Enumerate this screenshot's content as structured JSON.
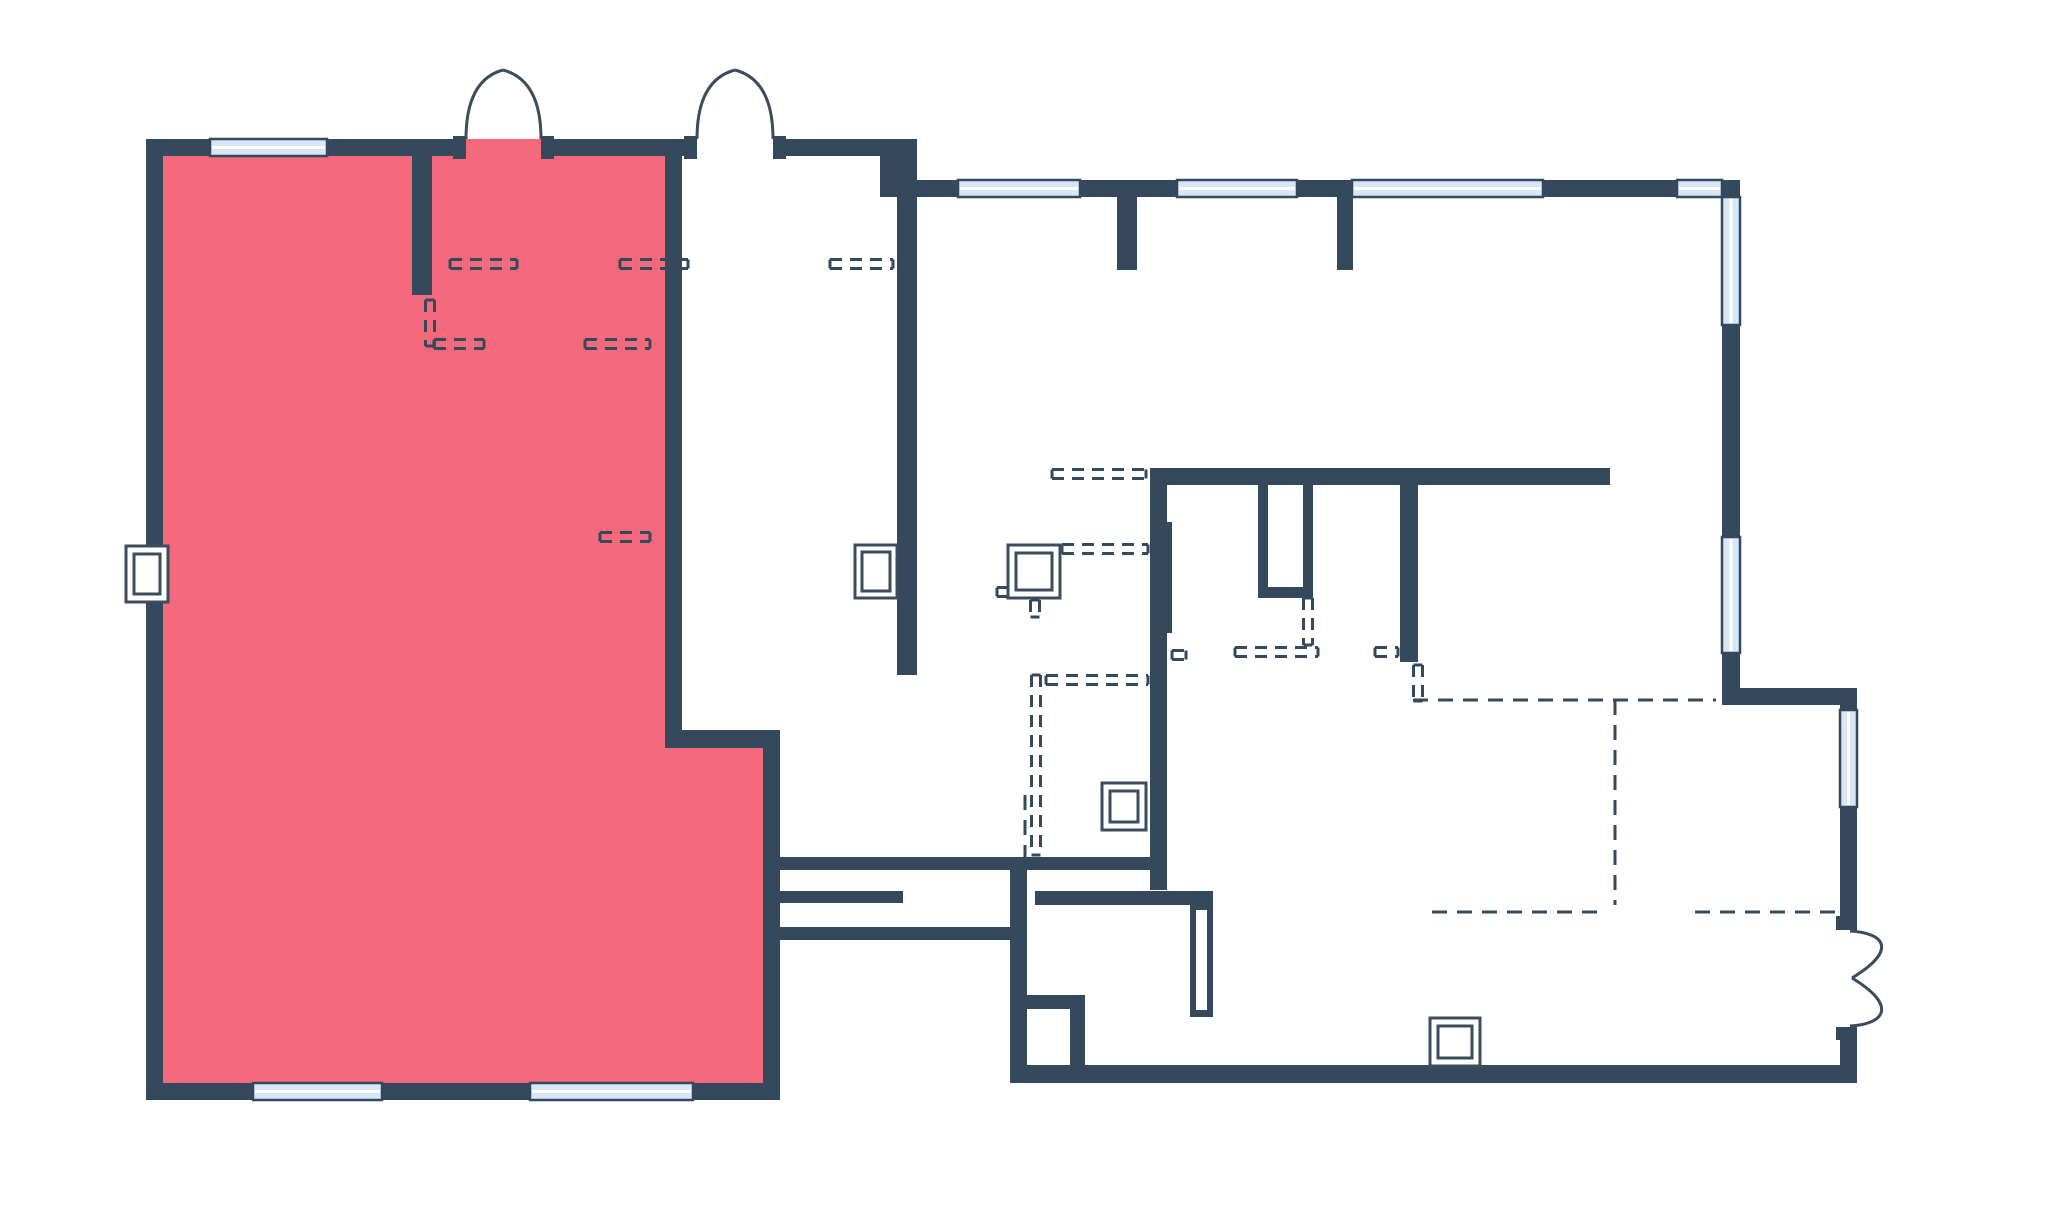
{
  "canvas": {
    "width": 2048,
    "height": 1205,
    "background": "#ffffff"
  },
  "colors": {
    "wall": "#35495c",
    "highlight_fill": "#f4697b",
    "window_fill": "#d8e7f6",
    "window_center_line": "#ffffff",
    "door_stroke": "#3b4c5c",
    "dash_stroke": "#35495c",
    "fixture_stroke": "#3b4c5c",
    "fixture_fill": "#ffffff"
  },
  "highlight_room": {
    "polygon": [
      [
        163,
        156
      ],
      [
        665,
        156
      ],
      [
        665,
        748
      ],
      [
        763,
        748
      ],
      [
        763,
        1083
      ],
      [
        163,
        1083
      ]
    ],
    "extra_rects": [
      [
        466,
        139,
        75,
        18
      ]
    ]
  },
  "walls": [
    [
      146,
      139,
      17,
      961
    ],
    [
      146,
      139,
      64,
      17
    ],
    [
      327,
      139,
      139,
      17
    ],
    [
      541,
      139,
      156,
      17
    ],
    [
      773,
      139,
      127,
      17
    ],
    [
      880,
      139,
      37,
      58
    ],
    [
      917,
      180,
      41,
      17
    ],
    [
      1080,
      180,
      97,
      17
    ],
    [
      1297,
      180,
      55,
      17
    ],
    [
      1543,
      180,
      134,
      17
    ],
    [
      1722,
      180,
      18,
      17
    ],
    [
      1722,
      325,
      18,
      212
    ],
    [
      1722,
      653,
      18,
      47
    ],
    [
      1722,
      688,
      135,
      17
    ],
    [
      1840,
      688,
      17,
      22
    ],
    [
      1840,
      807,
      17,
      111
    ],
    [
      1840,
      1027,
      17,
      56
    ],
    [
      1010,
      1065,
      847,
      18
    ],
    [
      146,
      1083,
      107,
      17
    ],
    [
      382,
      1083,
      148,
      17
    ],
    [
      693,
      1083,
      87,
      17
    ],
    [
      665,
      156,
      17,
      574
    ],
    [
      665,
      730,
      115,
      18
    ],
    [
      763,
      748,
      17,
      352
    ],
    [
      412,
      156,
      20,
      139
    ],
    [
      897,
      197,
      20,
      478
    ],
    [
      1117,
      197,
      20,
      73
    ],
    [
      1337,
      197,
      16,
      73
    ],
    [
      1150,
      468,
      460,
      17
    ],
    [
      1150,
      485,
      17,
      405
    ],
    [
      1167,
      522,
      5,
      111
    ],
    [
      1258,
      485,
      10,
      113
    ],
    [
      1303,
      485,
      10,
      113
    ],
    [
      1258,
      587,
      55,
      11
    ],
    [
      1400,
      485,
      18,
      177
    ],
    [
      780,
      857,
      370,
      13
    ],
    [
      775,
      891,
      128,
      12
    ],
    [
      1035,
      891,
      178,
      14
    ],
    [
      775,
      927,
      235,
      13
    ],
    [
      1010,
      870,
      17,
      213
    ],
    [
      1010,
      995,
      75,
      14
    ],
    [
      1070,
      1009,
      15,
      74
    ],
    [
      1190,
      905,
      23,
      112
    ],
    [
      453,
      136,
      13,
      23
    ],
    [
      541,
      136,
      13,
      23
    ],
    [
      684,
      136,
      13,
      23
    ],
    [
      773,
      136,
      13,
      23
    ],
    [
      1836,
      916,
      21,
      14
    ],
    [
      1836,
      1027,
      21,
      13
    ]
  ],
  "white_slots": [
    [
      1196,
      910,
      11,
      100
    ]
  ],
  "windows": [
    {
      "rect": [
        210,
        139,
        117,
        17
      ],
      "orient": "h"
    },
    {
      "rect": [
        958,
        180,
        122,
        17
      ],
      "orient": "h"
    },
    {
      "rect": [
        1177,
        180,
        120,
        17
      ],
      "orient": "h"
    },
    {
      "rect": [
        1352,
        180,
        191,
        17
      ],
      "orient": "h"
    },
    {
      "rect": [
        1677,
        180,
        45,
        17
      ],
      "orient": "h"
    },
    {
      "rect": [
        1722,
        197,
        18,
        128
      ],
      "orient": "v"
    },
    {
      "rect": [
        1722,
        537,
        18,
        116
      ],
      "orient": "v"
    },
    {
      "rect": [
        1840,
        710,
        17,
        97
      ],
      "orient": "v"
    },
    {
      "rect": [
        253,
        1083,
        129,
        17
      ],
      "orient": "h"
    },
    {
      "rect": [
        530,
        1083,
        163,
        17
      ],
      "orient": "h"
    }
  ],
  "doors": [
    {
      "name": "double-door-top-left",
      "path": "M466,139 Q466,80 503,70 M541,139 Q541,80 503,70"
    },
    {
      "name": "double-door-top-center",
      "path": "M697,139 Q697,80 735,70 M773,139 Q773,80 735,70"
    },
    {
      "name": "french-door-right",
      "path": "M1850,931 C1885,933 1898,950 1852,978 M1850,1026 C1885,1024 1898,1006 1852,978"
    }
  ],
  "dashed_double": [
    {
      "p": [
        430,
        300,
        430,
        346
      ]
    },
    {
      "p": [
        434,
        344,
        484,
        344
      ]
    },
    {
      "p": [
        585,
        344,
        650,
        344
      ]
    },
    {
      "p": [
        450,
        264,
        517,
        264
      ]
    },
    {
      "p": [
        620,
        264,
        688,
        264
      ]
    },
    {
      "p": [
        830,
        264,
        893,
        264
      ]
    },
    {
      "p": [
        600,
        537,
        650,
        537
      ]
    },
    {
      "p": [
        1036,
        675,
        1036,
        855
      ]
    },
    {
      "p": [
        1046,
        680,
        1148,
        680
      ]
    },
    {
      "p": [
        1062,
        549,
        1148,
        549
      ]
    },
    {
      "p": [
        1035,
        600,
        1035,
        617
      ]
    },
    {
      "p": [
        1308,
        598,
        1308,
        645
      ]
    },
    {
      "p": [
        1235,
        652,
        1318,
        652
      ]
    },
    {
      "p": [
        1172,
        655,
        1186,
        655
      ]
    },
    {
      "p": [
        1375,
        652,
        1398,
        652
      ]
    },
    {
      "p": [
        1418,
        665,
        1418,
        701
      ]
    },
    {
      "p": [
        1052,
        474,
        1146,
        474
      ]
    },
    {
      "p": [
        997,
        592,
        1010,
        592
      ]
    }
  ],
  "dashed_single": [
    {
      "p": [
        1413,
        700,
        1716,
        700
      ]
    },
    {
      "p": [
        1615,
        700,
        1615,
        905
      ]
    },
    {
      "p": [
        1432,
        912,
        1607,
        912
      ]
    },
    {
      "p": [
        1695,
        912,
        1836,
        912
      ]
    },
    {
      "p": [
        1025,
        795,
        1025,
        857
      ]
    }
  ],
  "fixtures": [
    {
      "name": "sink-fixture",
      "outer": [
        855,
        545,
        42,
        53
      ],
      "inner": [
        862,
        552,
        28,
        39
      ]
    },
    {
      "name": "toilet-fixture",
      "outer": [
        1008,
        545,
        52,
        53
      ],
      "inner": [
        1016,
        553,
        36,
        37
      ]
    },
    {
      "name": "wall-box-fixture",
      "outer": [
        126,
        546,
        42,
        56
      ],
      "inner": [
        134,
        554,
        26,
        40
      ]
    },
    {
      "name": "drain-fixture",
      "outer": [
        1102,
        783,
        44,
        47
      ],
      "inner": [
        1110,
        791,
        28,
        31
      ]
    },
    {
      "name": "floor-fixture",
      "outer": [
        1430,
        1018,
        50,
        48
      ],
      "inner": [
        1438,
        1026,
        34,
        32
      ]
    }
  ]
}
